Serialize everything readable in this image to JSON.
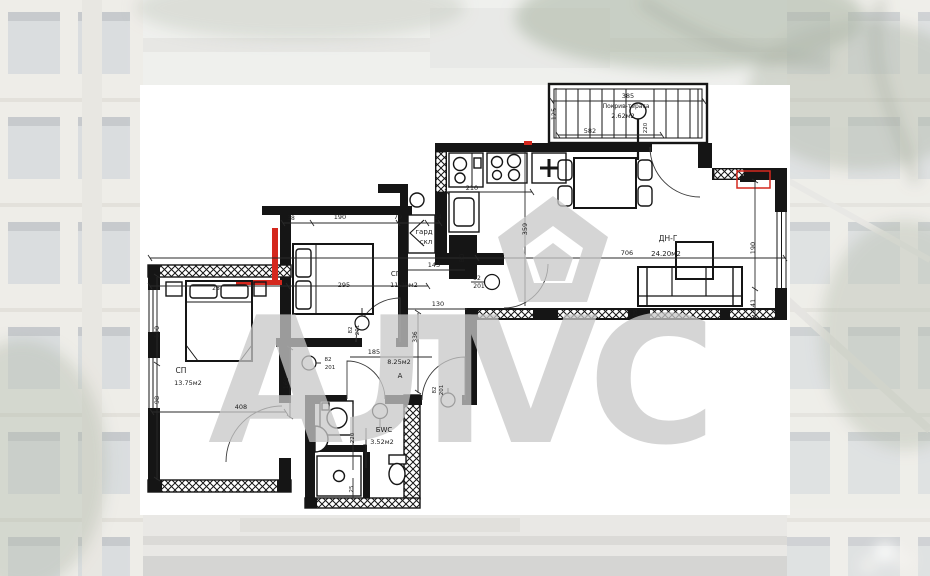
{
  "colors": {
    "plan_line": "#151515",
    "highlight_red": "#d4281e",
    "watermark_gray": "#c8c8c8",
    "paper": "#ffffff"
  },
  "watermark": {
    "icon": "pentagon-house-icon",
    "letters": [
      {
        "name": "watermark-letter-a",
        "t": "А",
        "x": 208,
        "y": 442
      },
      {
        "name": "watermark-letter-l",
        "t": "Л",
        "x": 342,
        "y": 442
      },
      {
        "name": "watermark-letter-v",
        "t": "V",
        "x": 463,
        "y": 442
      },
      {
        "name": "watermark-letter-c",
        "t": "С",
        "x": 588,
        "y": 442
      }
    ]
  },
  "plan": {
    "rooms_summary": [
      {
        "label": "СП",
        "area": "13.75м2"
      },
      {
        "label": "СП",
        "area": "11.29м2"
      },
      {
        "label": "ДН-Г",
        "area": "24.20м2"
      },
      {
        "label": "БWC",
        "area": "3.52м2"
      },
      {
        "label": "А",
        "area": "8.25м2"
      },
      {
        "label": "Покрив-тераса",
        "area": "2.62м2"
      },
      {
        "label": "гард скл",
        "area": ""
      }
    ],
    "texts": [
      {
        "name": "dim-terrace-385",
        "t": "385",
        "x": 628,
        "y": 98,
        "s": 6.5
      },
      {
        "name": "terrace-label",
        "t": "Покрив-тераса",
        "x": 626,
        "y": 108,
        "s": 6
      },
      {
        "name": "terrace-area",
        "t": "2.62м2",
        "x": 623,
        "y": 118,
        "s": 6.5
      },
      {
        "name": "dim-terrace-125",
        "t": "125",
        "x": 556,
        "y": 114,
        "s": 6.5,
        "r": -90
      },
      {
        "name": "dim-terrace-582",
        "t": "582",
        "x": 590,
        "y": 133,
        "s": 6.5
      },
      {
        "name": "dim-terrace-220",
        "t": "220",
        "x": 647,
        "y": 128,
        "s": 5.5,
        "r": -90
      },
      {
        "name": "dim-kitchen-210",
        "t": "210",
        "x": 472,
        "y": 190,
        "s": 6.5
      },
      {
        "name": "kitchen-unit-label",
        "t": "ВО",
        "x": 464,
        "y": 258,
        "s": 6,
        "r": -90,
        "c": "#ffffff"
      },
      {
        "name": "dim-359",
        "t": "359",
        "x": 527,
        "y": 229,
        "s": 6.5,
        "r": -90
      },
      {
        "name": "room-living-name",
        "t": "ДН-Г",
        "x": 668,
        "y": 241,
        "s": 7.5
      },
      {
        "name": "room-living-area",
        "t": "24.20м2",
        "x": 666,
        "y": 256,
        "s": 7
      },
      {
        "name": "dim-706",
        "t": "706",
        "x": 627,
        "y": 255,
        "s": 6.5
      },
      {
        "name": "dim-right-190",
        "t": "190",
        "x": 755,
        "y": 248,
        "s": 6.5,
        "r": -90
      },
      {
        "name": "dim-right-41",
        "t": "41",
        "x": 755,
        "y": 303,
        "s": 6.5,
        "r": -90
      },
      {
        "name": "dim-sofa-25",
        "t": "25",
        "x": 637,
        "y": 313,
        "s": 5.5,
        "r": -90
      },
      {
        "name": "dim-38",
        "t": "38",
        "x": 291,
        "y": 220,
        "s": 6
      },
      {
        "name": "dim-mid-190",
        "t": "190",
        "x": 340,
        "y": 219,
        "s": 6.5
      },
      {
        "name": "dim-79",
        "t": "79",
        "x": 398,
        "y": 219,
        "s": 6.5
      },
      {
        "name": "dim-14",
        "t": "14",
        "x": 438,
        "y": 219,
        "s": 6
      },
      {
        "name": "closet-line1",
        "t": "гард",
        "x": 424,
        "y": 234,
        "s": 7
      },
      {
        "name": "closet-line2",
        "t": "скл",
        "x": 426,
        "y": 244,
        "s": 7
      },
      {
        "name": "dim-143",
        "t": "143",
        "x": 434,
        "y": 267,
        "s": 6.5
      },
      {
        "name": "room-mid-name",
        "t": "СП",
        "x": 396,
        "y": 276,
        "s": 7
      },
      {
        "name": "dim-295",
        "t": "295",
        "x": 344,
        "y": 287,
        "s": 6.5
      },
      {
        "name": "room-mid-area",
        "t": "11.29м2",
        "x": 404,
        "y": 287,
        "s": 6.5
      },
      {
        "name": "dim-130",
        "t": "130",
        "x": 438,
        "y": 306,
        "s": 6.5
      },
      {
        "name": "switch-92",
        "t": "92",
        "x": 477,
        "y": 280,
        "s": 6
      },
      {
        "name": "switch-92-201",
        "t": "201",
        "x": 479,
        "y": 288,
        "s": 6
      },
      {
        "name": "dim-336",
        "t": "336",
        "x": 417,
        "y": 337,
        "s": 6,
        "r": -90
      },
      {
        "name": "dim-185",
        "t": "185",
        "x": 374,
        "y": 354,
        "s": 6.5
      },
      {
        "name": "hall-area",
        "t": "8.25м2",
        "x": 399,
        "y": 364,
        "s": 6.5
      },
      {
        "name": "hall-name",
        "t": "А",
        "x": 400,
        "y": 378,
        "s": 7
      },
      {
        "name": "switch-82a",
        "t": "82",
        "x": 352,
        "y": 330,
        "s": 5.5,
        "r": -90
      },
      {
        "name": "switch-201a",
        "t": "201",
        "x": 359,
        "y": 330,
        "s": 5.5,
        "r": -90
      },
      {
        "name": "switch-82b",
        "t": "82",
        "x": 328,
        "y": 361,
        "s": 5.5
      },
      {
        "name": "switch-201b",
        "t": "201",
        "x": 330,
        "y": 369,
        "s": 5.5
      },
      {
        "name": "switch-82c",
        "t": "82",
        "x": 436,
        "y": 390,
        "s": 5.5,
        "r": -90
      },
      {
        "name": "switch-201c",
        "t": "201",
        "x": 443,
        "y": 390,
        "s": 5.5,
        "r": -90
      },
      {
        "name": "dim-169",
        "t": "169",
        "x": 288,
        "y": 383,
        "s": 6.5,
        "r": -90
      },
      {
        "name": "room-left-name",
        "t": "СП",
        "x": 181,
        "y": 373,
        "s": 7.5
      },
      {
        "name": "room-left-area",
        "t": "13.75м2",
        "x": 188,
        "y": 385,
        "s": 6.5
      },
      {
        "name": "dim-left-190",
        "t": "190",
        "x": 159,
        "y": 332,
        "s": 6.5,
        "r": -90
      },
      {
        "name": "dim-left-98",
        "t": "98",
        "x": 159,
        "y": 400,
        "s": 6.5,
        "r": -90
      },
      {
        "name": "dim-408",
        "t": "408",
        "x": 241,
        "y": 409,
        "s": 6.5
      },
      {
        "name": "dim-28",
        "t": "28",
        "x": 216,
        "y": 290,
        "s": 6
      },
      {
        "name": "room-bath-name",
        "t": "БWC",
        "x": 384,
        "y": 432,
        "s": 7
      },
      {
        "name": "room-bath-area",
        "t": "3.52м2",
        "x": 382,
        "y": 444,
        "s": 6.5
      },
      {
        "name": "dim-bath-220",
        "t": "220",
        "x": 354,
        "y": 438,
        "s": 5.5,
        "r": -90
      },
      {
        "name": "dim-bath-140",
        "t": "140",
        "x": 367,
        "y": 449,
        "s": 5.5,
        "r": -90
      },
      {
        "name": "dim-bath-25",
        "t": "25",
        "x": 353,
        "y": 489,
        "s": 5.5,
        "r": -90
      }
    ]
  }
}
